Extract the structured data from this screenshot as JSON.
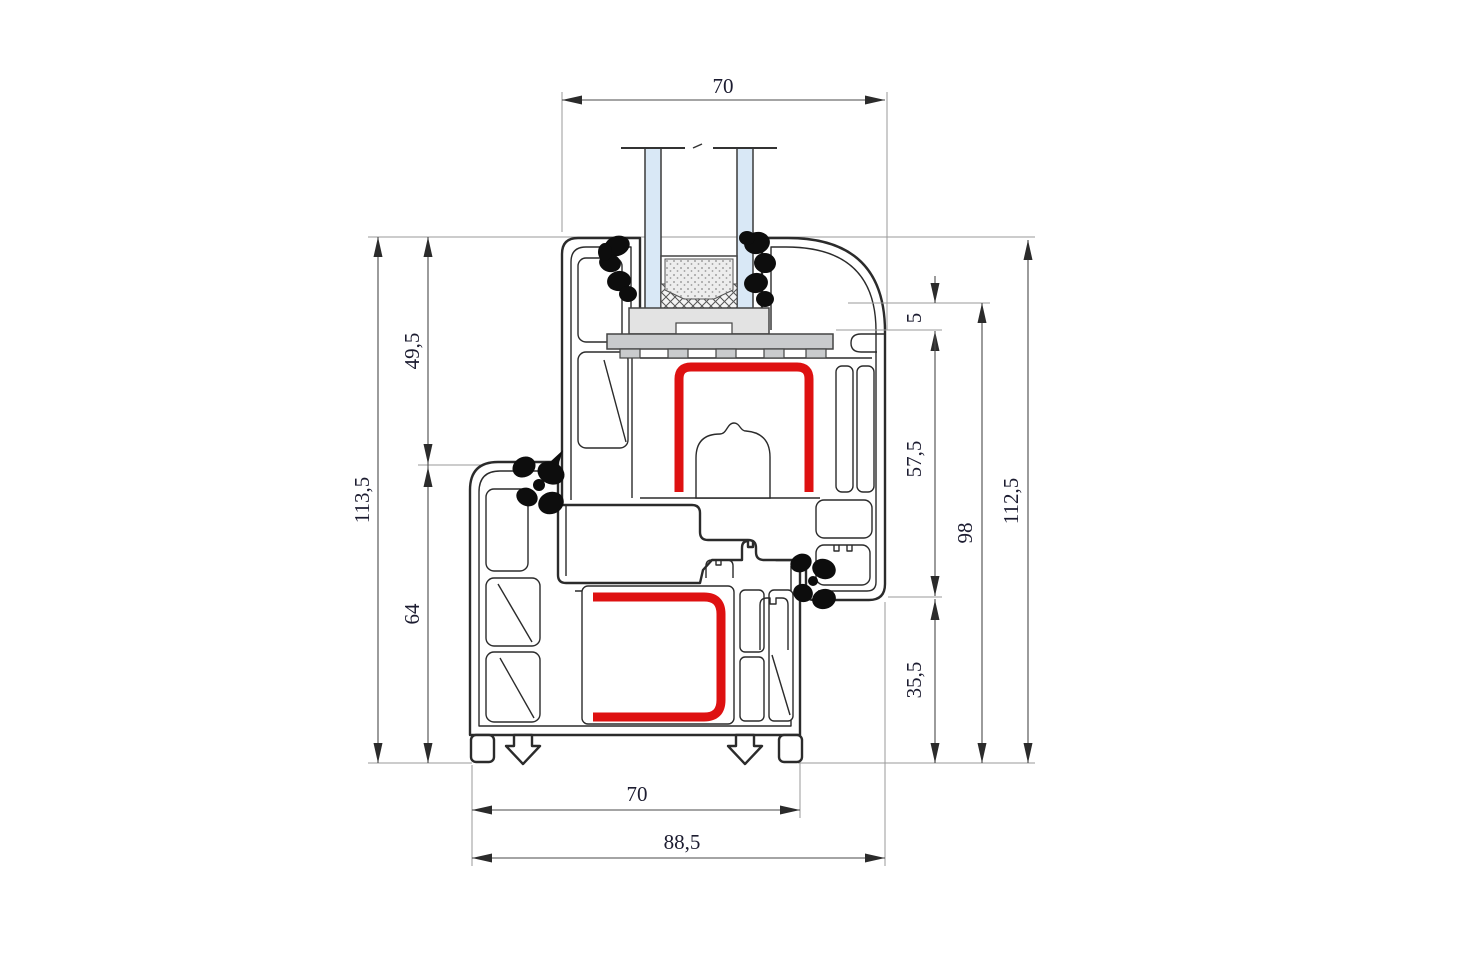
{
  "drawing": {
    "kind": "window-profile-cross-section",
    "dimensions": {
      "top_width": "70",
      "sash_height": "49,5",
      "total_height_left": "113,5",
      "frame_height": "64",
      "drip_step": "5",
      "sash_face_height": "57,5",
      "rebate_height": "98",
      "total_height_right": "112,5",
      "lower_frame_height": "35,5",
      "frame_width": "70",
      "total_width": "88,5"
    },
    "colors": {
      "reinforcement_red": "#de1111",
      "glass_blue": "#d9e8f6",
      "gasket_black": "#0d0d0d",
      "profile_line": "#2b2b2b",
      "packer_gray": "#e3e3e3",
      "bridge_gray": "#c9cbcd"
    }
  }
}
